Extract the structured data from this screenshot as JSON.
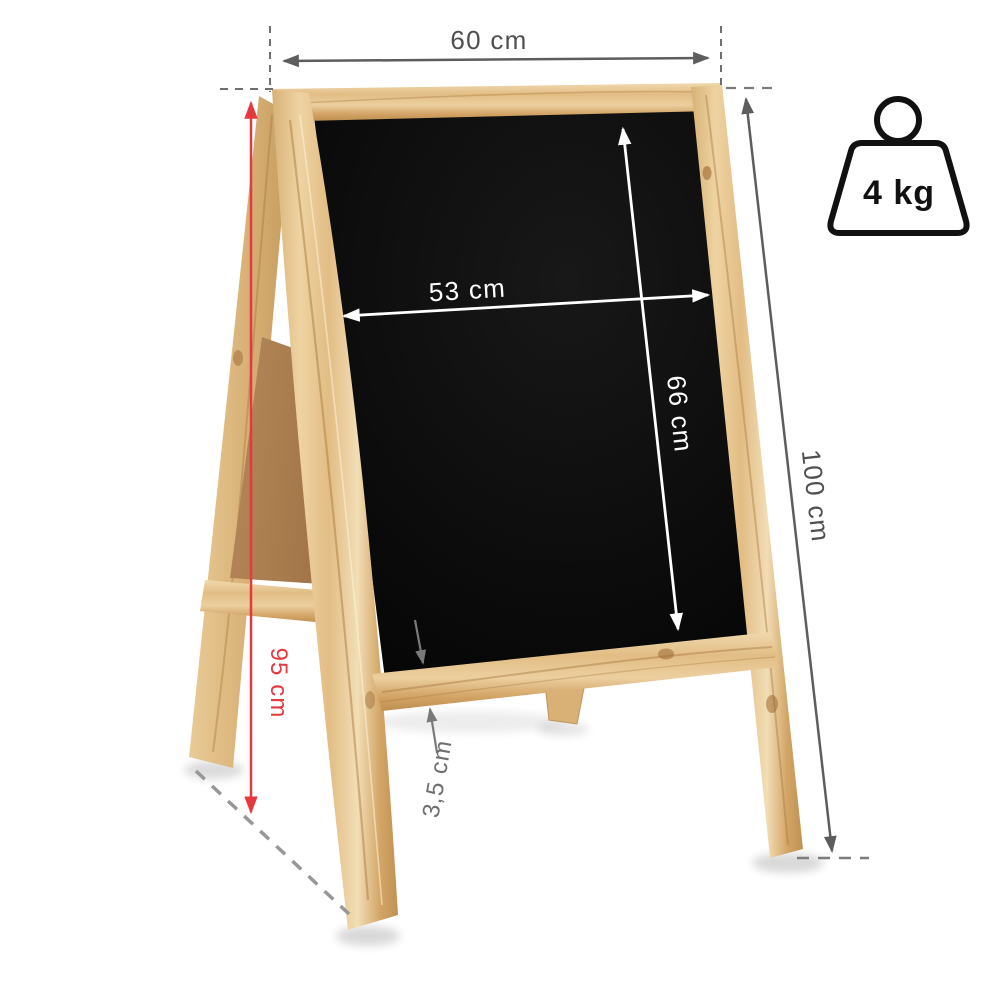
{
  "dimensions": {
    "outer_width": "60 cm",
    "board_width": "53 cm",
    "board_height": "66 cm",
    "total_height": "100 cm",
    "side_height": "95 cm",
    "frame_thickness": "3,5 cm"
  },
  "weight": {
    "label": "4 kg"
  },
  "colors": {
    "accent_red": "#e6393f",
    "dimension_gray": "#4f4f4f",
    "dimension_light_gray": "#6e6e6e",
    "dash_gray": "#8f8f8f",
    "annotation_white": "#ffffff",
    "wood_light": "#efd5a6",
    "wood_mid": "#e0ba82",
    "wood_dark": "#c2945a",
    "mdf_brown": "#aa7d4f",
    "board_black": "#0b0b0b",
    "icon_black": "#111111"
  }
}
